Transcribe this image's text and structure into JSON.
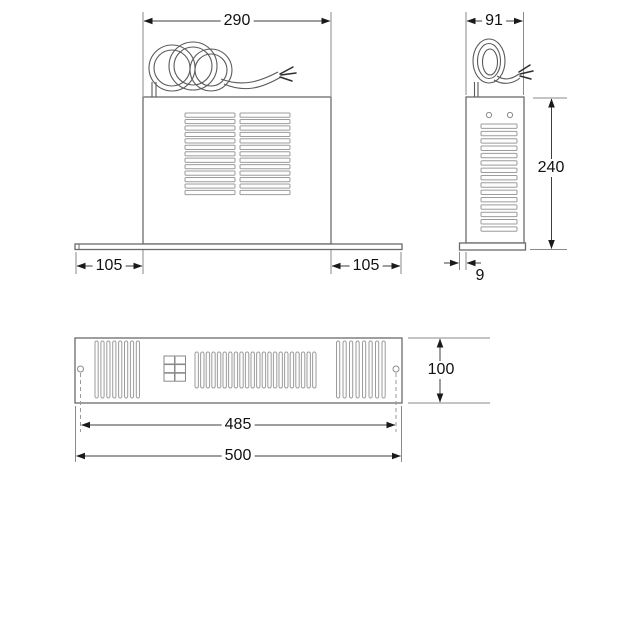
{
  "drawing": {
    "type": "dimensional-technical-drawing",
    "subject": "plinth heater unit with power cable, three orthographic views",
    "line_color": "#6b6b6b",
    "dimension_color": "#1a1a1a",
    "background": "#ffffff"
  },
  "views": {
    "front": {
      "name": "front view with cable coil on top of body and wide baseplate",
      "dim_width": "290",
      "dim_overhang_left": "105",
      "dim_overhang_right": "105",
      "vent_columns": 2,
      "vent_rows": 13
    },
    "side": {
      "name": "side view with cable coil, vent slots and base lip",
      "dim_width": "91",
      "dim_height": "240",
      "dim_base_lip": "9",
      "vent_rows": 15,
      "pilot_holes": 2
    },
    "panel": {
      "name": "front grille panel with fixing holes and switch block",
      "dim_height": "100",
      "dim_fixing_centres": "485",
      "dim_width": "500",
      "left_slats": 8,
      "middle_slats": 22,
      "right_slats": 8,
      "fixing_holes": 2,
      "switch_cells_cols": 2,
      "switch_cells_rows": 3
    }
  }
}
